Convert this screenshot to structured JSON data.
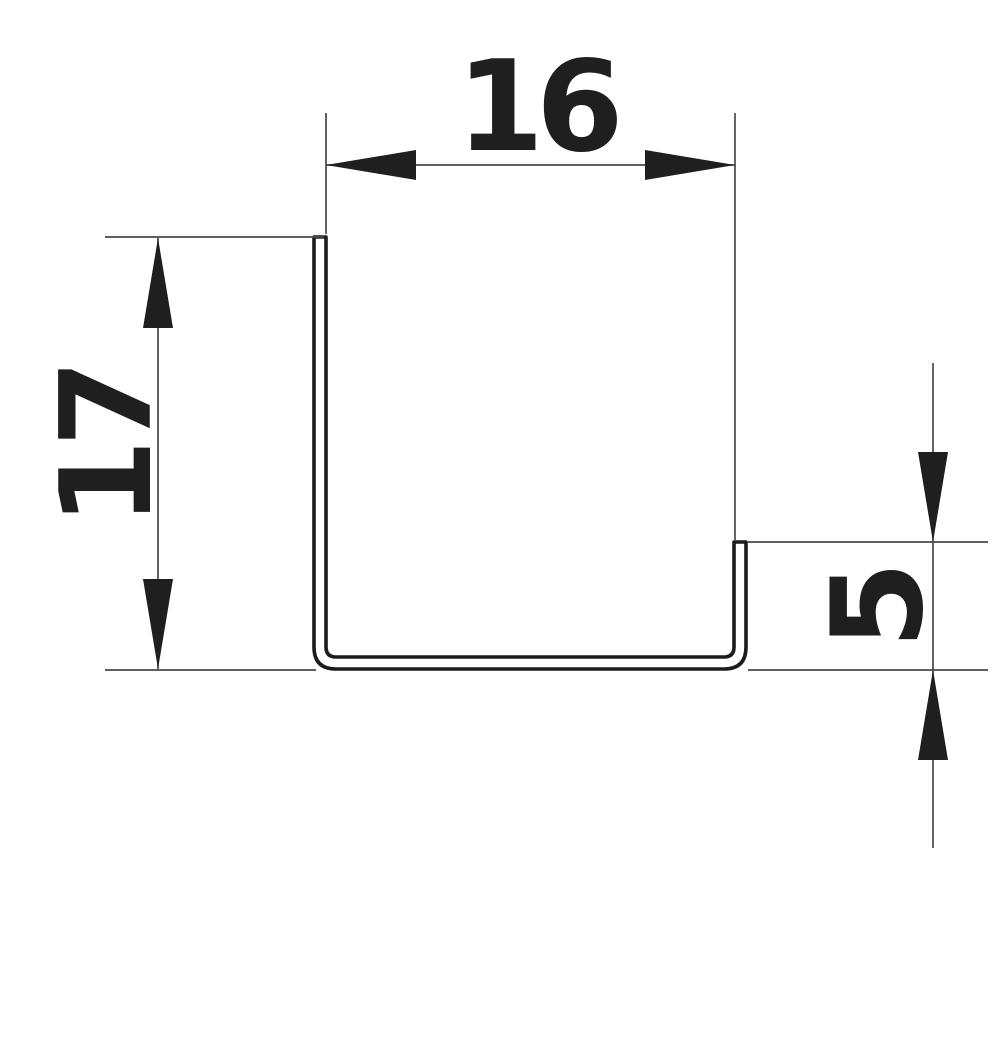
{
  "drawing": {
    "title": "Channel profile cross-section",
    "description": "Dimensioned cross-section of a J-shaped sheet channel profile: tall left leg, flat bottom with rounded corners, short right lip",
    "background_color": "#ffffff",
    "ink_color": "#1f1f1f",
    "thin_line_color": "#494949",
    "dimensions": {
      "width": {
        "value": "16",
        "orientation": "horizontal",
        "position": "top",
        "arrow_style": "outward"
      },
      "height": {
        "value": "17",
        "orientation": "vertical",
        "position": "left",
        "arrow_style": "outward"
      },
      "lip": {
        "value": "5",
        "orientation": "vertical",
        "position": "right",
        "arrow_style": "inward-outside"
      }
    }
  }
}
